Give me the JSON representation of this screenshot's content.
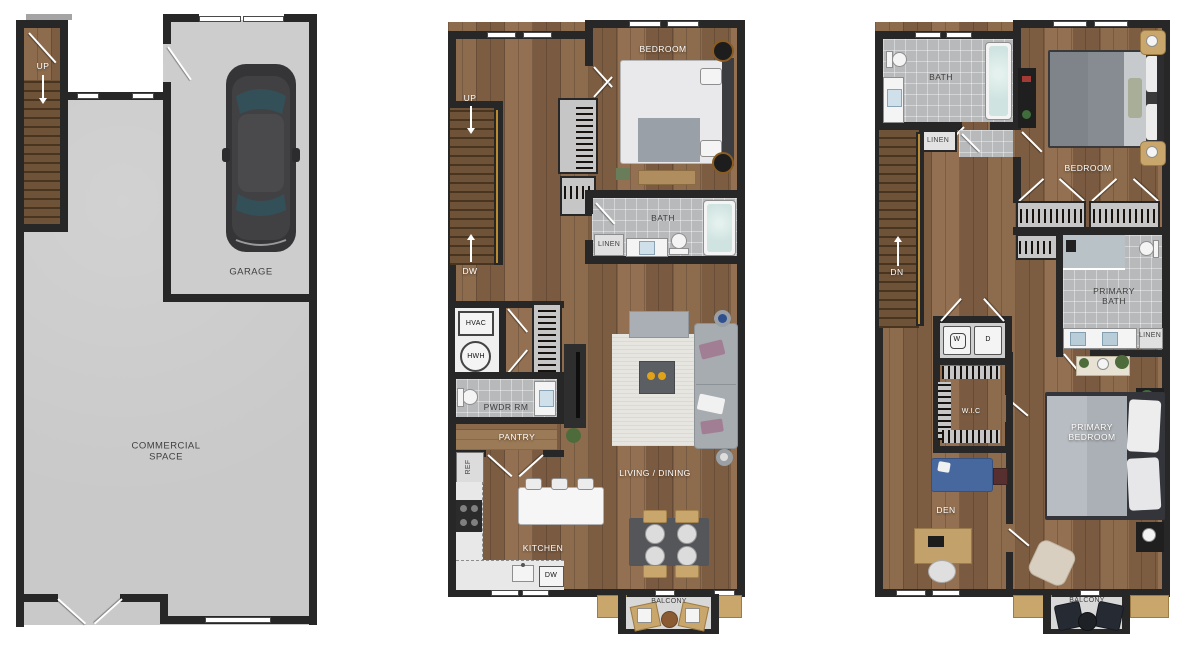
{
  "colors": {
    "wall": "#272727",
    "wood_floor": "#86654a",
    "tile_floor": "#b8b9bb",
    "concrete_floor": "#c9c9c9",
    "accent_tan": "#c9a66b",
    "stair_rail_gold": "#b98a2f",
    "tub_water": "#cfe3e0",
    "label_dark": "#3f3f3f",
    "label_light": "#ffffff"
  },
  "floor1": {
    "up": "UP",
    "garage": "GARAGE",
    "commercial_space": "COMMERCIAL\nSPACE"
  },
  "floor2": {
    "bedroom": "BEDROOM",
    "bath": "BATH",
    "linen": "LINEN",
    "up": "UP",
    "down": "DW",
    "hvac": "HVAC",
    "water_heater": "HWH",
    "powder_room": "PWDR RM",
    "pantry": "PANTRY",
    "refrigerator": "REF",
    "kitchen": "KITCHEN",
    "dishwasher": "DW",
    "living_dining": "LIVING / DINING",
    "balcony": "BALCONY"
  },
  "floor3": {
    "bath": "BATH",
    "linen": "LINEN",
    "bedroom": "BEDROOM",
    "down": "DN",
    "washer": "W",
    "dryer": "D",
    "walk_in_closet": "W.I.C",
    "primary_bath": "PRIMARY\nBATH",
    "primary_bath_linen": "LINEN",
    "primary_bedroom": "PRIMARY\nBEDROOM",
    "den": "DEN",
    "balcony": "BALCONY"
  }
}
